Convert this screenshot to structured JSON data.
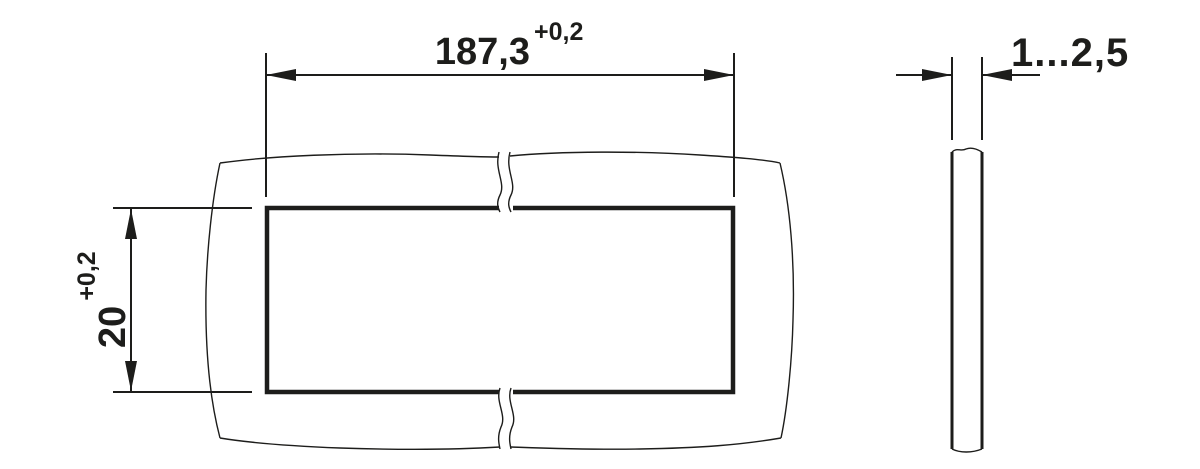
{
  "drawing": {
    "kind": "panel-cutout-dimensional-drawing",
    "line_color": "#1d1d1b",
    "background_color": "#ffffff",
    "front_view": {
      "width_dimension": {
        "value": "187,3",
        "tolerance": "+0,2"
      },
      "height_dimension": {
        "value": "20",
        "tolerance": "+0,2"
      }
    },
    "side_view": {
      "thickness_dimension": {
        "value": "1...2,5"
      }
    }
  }
}
